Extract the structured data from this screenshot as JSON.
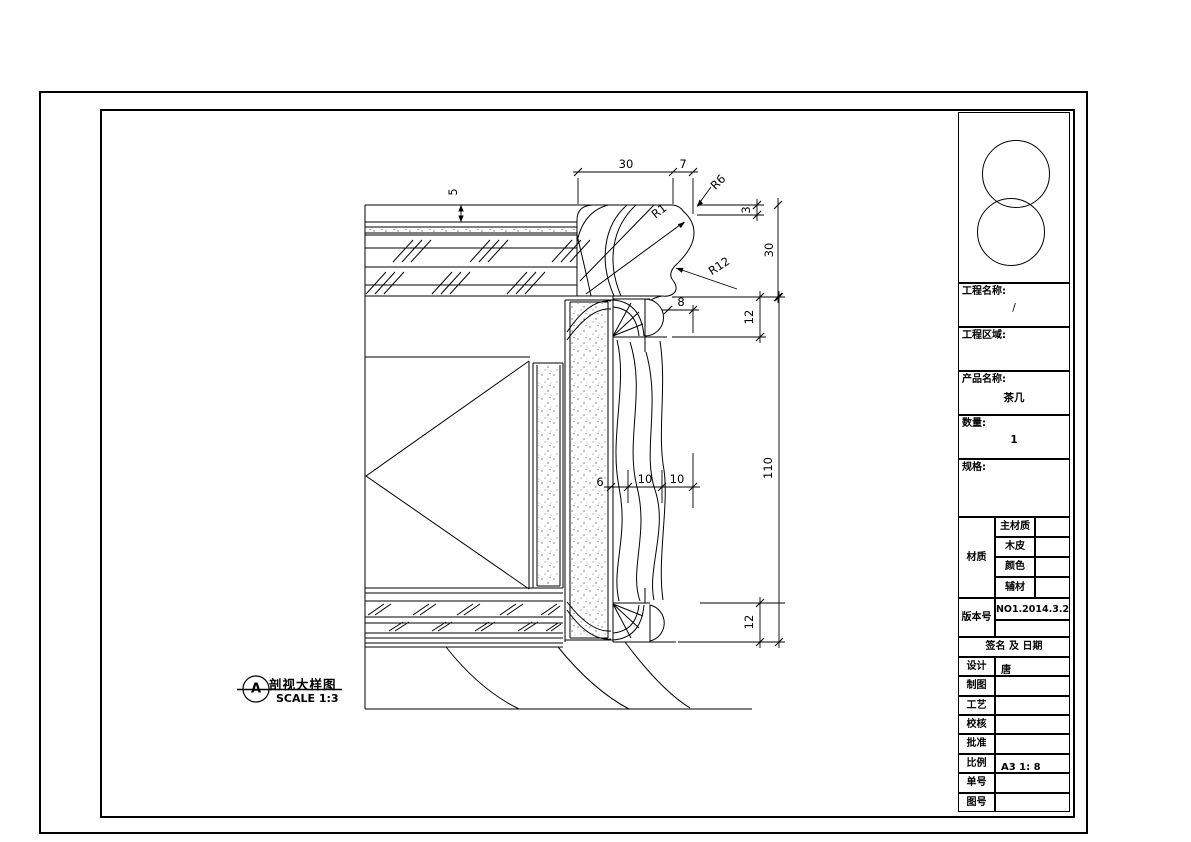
{
  "callout": {
    "letter": "A",
    "title": "剖视大样图",
    "scale": "SCALE 1:3"
  },
  "dimensions": {
    "top_w1": "30",
    "top_w2": "7",
    "r6": "R6",
    "r1": "R1",
    "r12": "R12",
    "edge_step": "3",
    "edge_h": "30",
    "bead_top": "12",
    "board_h": "110",
    "bead_bottom": "12",
    "nose": "8",
    "carve_a": "6",
    "carve_b": "10",
    "carve_c": "10",
    "top_thk": "5"
  },
  "titleblock": {
    "project_name_label": "工程名称:",
    "project_name_value": "/",
    "project_area_label": "工程区域:",
    "project_area_value": "",
    "product_name_label": "产品名称:",
    "product_name_value": "茶几",
    "quantity_label": "数量:",
    "quantity_value": "1",
    "spec_label": "规格:",
    "spec_value": "",
    "material_label": "材质",
    "material_rows": [
      {
        "label": "主材质",
        "value": ""
      },
      {
        "label": "木皮",
        "value": ""
      },
      {
        "label": "颜色",
        "value": ""
      },
      {
        "label": "辅材",
        "value": ""
      }
    ],
    "version_label": "版本号",
    "version_value": "NO1.2014.3.2",
    "version_value2": "",
    "sign_header": "签名 及 日期",
    "sign_rows": [
      {
        "label": "设计",
        "value": "唐"
      },
      {
        "label": "制图",
        "value": ""
      },
      {
        "label": "工艺",
        "value": ""
      },
      {
        "label": "校核",
        "value": ""
      },
      {
        "label": "批准",
        "value": ""
      },
      {
        "label": "比例",
        "value": "A3 1: 8"
      },
      {
        "label": "单号",
        "value": ""
      },
      {
        "label": "图号",
        "value": ""
      }
    ]
  }
}
